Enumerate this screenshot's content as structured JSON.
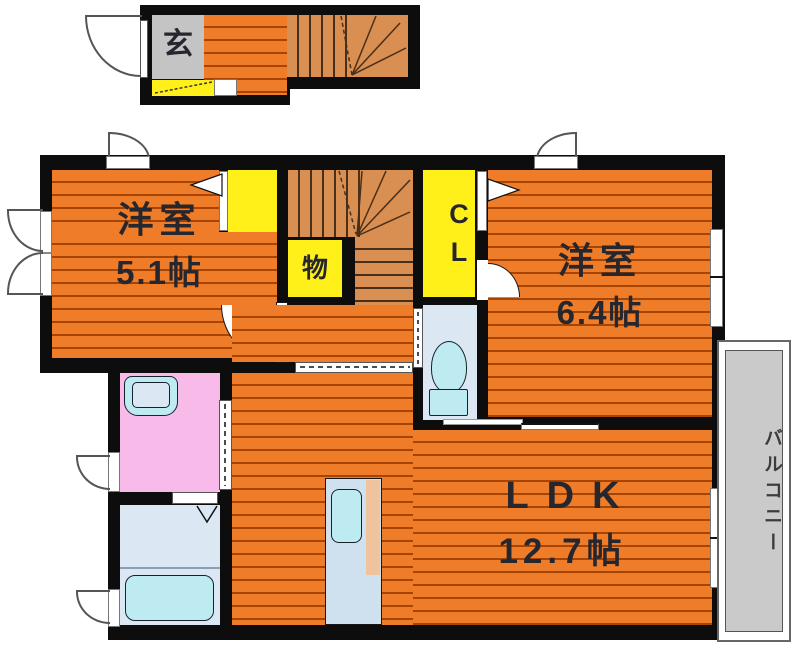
{
  "colors": {
    "orange": "#EE7C28",
    "plankLine": "#A64400",
    "stair": "#D98E52",
    "stairLine": "#4A2F18",
    "yellow": "#FFF01A",
    "genkanGray": "#C4C4C4",
    "pink": "#F8BBE9",
    "bathBlue": "#DBE8F4",
    "fixtureCyan": "#BEEBF2",
    "kitchenBlue": "#CFE0EF",
    "counterTan": "#EFC39E",
    "balconyGray": "#CACACA",
    "wall": "#0D0D0D",
    "text": "#26262E"
  },
  "entrance": {
    "label": "玄"
  },
  "rooms": {
    "bedroom1": {
      "name": "洋室",
      "size": "5.1帖"
    },
    "bedroom2": {
      "name": "洋室",
      "size": "6.4帖"
    },
    "ldk": {
      "name": "LDK",
      "size": "12.7帖"
    },
    "closet": {
      "label": "CL"
    },
    "storage": {
      "label": "物"
    },
    "balcony": {
      "label": "バルコニー"
    }
  }
}
